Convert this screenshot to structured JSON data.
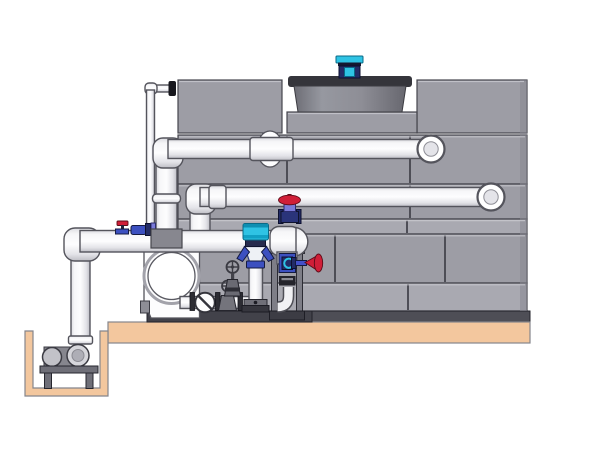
{
  "scene": {
    "description": "Cooling tower with external piping, pump skid and sump pit pump",
    "background": "#ffffff"
  },
  "colors": {
    "panel": "#9d9da5",
    "panelLight": "#a9a9b1",
    "panelDark": "#87878f",
    "seam": "#45454d",
    "pipeOutline": "#54545c",
    "drum": "#8b8b93",
    "drumTop": "#35353b",
    "motorCyan": "#2fc3e4",
    "valveNavy": "#232c66",
    "valveBlue": "#3c50c0",
    "valvePurple": "#7a7ad8",
    "handwheelRed": "#d01f38",
    "steel": "#6f6f78",
    "darkMetal": "#2c2c33",
    "slab": "#f3c79e",
    "slabOutline": "#85858c"
  },
  "components": [
    {
      "id": "cooling-tower-casing",
      "label": "cooling tower casing panels"
    },
    {
      "id": "fan-cowl",
      "label": "fan cowl drum"
    },
    {
      "id": "fan-motor",
      "label": "cyan fan motor"
    },
    {
      "id": "upper-return-pipe",
      "label": "upper return pipe with elbow and end cap"
    },
    {
      "id": "lower-return-pipe",
      "label": "lower return pipe with elbow and end cap"
    },
    {
      "id": "makeup-pipe",
      "label": "thin make-up water pipe"
    },
    {
      "id": "suction-header",
      "label": "suction header pipe with drop leg"
    },
    {
      "id": "riser-globe-valve",
      "label": "globe valve with red handwheel"
    },
    {
      "id": "drain-valve",
      "label": "small red handwheel drain valve"
    },
    {
      "id": "ball-valve",
      "label": "blue ball valve on header"
    },
    {
      "id": "check-valve",
      "label": "swing check valve"
    },
    {
      "id": "gate-valve",
      "label": "gate valves with spoked handwheels"
    },
    {
      "id": "pump-volute",
      "label": "white pump volute housing"
    },
    {
      "id": "chemical-injector",
      "label": "chemical injector with cyan canister"
    },
    {
      "id": "equipment-frame",
      "label": "steel equipment frame"
    },
    {
      "id": "sump-pit",
      "label": "concrete sump pit"
    },
    {
      "id": "pit-pump",
      "label": "horizontal pump on stand in pit"
    },
    {
      "id": "concrete-slab",
      "label": "concrete floor slab"
    }
  ]
}
